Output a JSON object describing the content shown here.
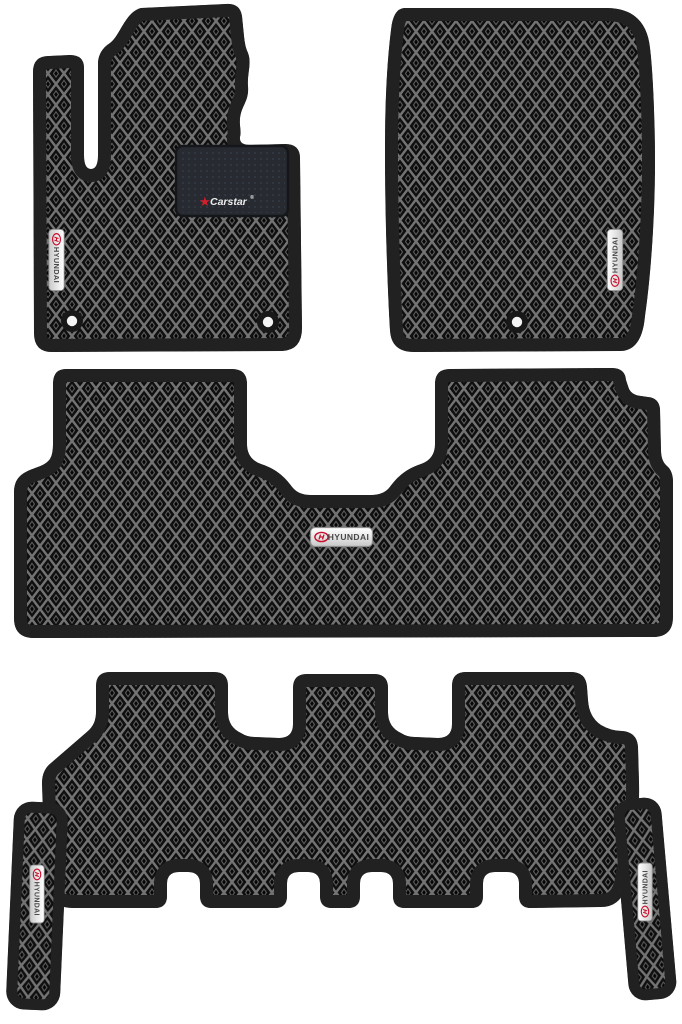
{
  "image": {
    "kind": "product-photo",
    "subject": "Set of six black EVA car floor mats with rhombus honeycomb pattern",
    "background_color": "#ffffff"
  },
  "branding": {
    "badge_label": "HYUNDAI",
    "heel_pad_logo": "Carstar",
    "registered_mark": "®"
  },
  "colors": {
    "mat_base": "#0f0f0f",
    "mat_lattice": "#747474",
    "mat_edge_band": "#212121",
    "heel_pad": "#272b31",
    "badge_silver": "#e9e9e9",
    "brand_red": "#c8102e",
    "hole_white": "#f4f4f4"
  },
  "mats": [
    {
      "name": "front-left-driver-mat",
      "badge": "HYUNDAI",
      "heel_pad": true,
      "fastener_holes": 2
    },
    {
      "name": "front-right-passenger-mat",
      "badge": "HYUNDAI",
      "heel_pad": false,
      "fastener_holes": 1
    },
    {
      "name": "second-row-mat",
      "badge": "HYUNDAI",
      "heel_pad": false,
      "fastener_holes": 0
    },
    {
      "name": "third-row-mat",
      "badge": "",
      "heel_pad": false,
      "fastener_holes": 0
    },
    {
      "name": "left-side-strip-mat",
      "badge": "HYUNDAI",
      "heel_pad": false,
      "fastener_holes": 0
    },
    {
      "name": "right-side-strip-mat",
      "badge": "HYUNDAI",
      "heel_pad": false,
      "fastener_holes": 0
    }
  ]
}
